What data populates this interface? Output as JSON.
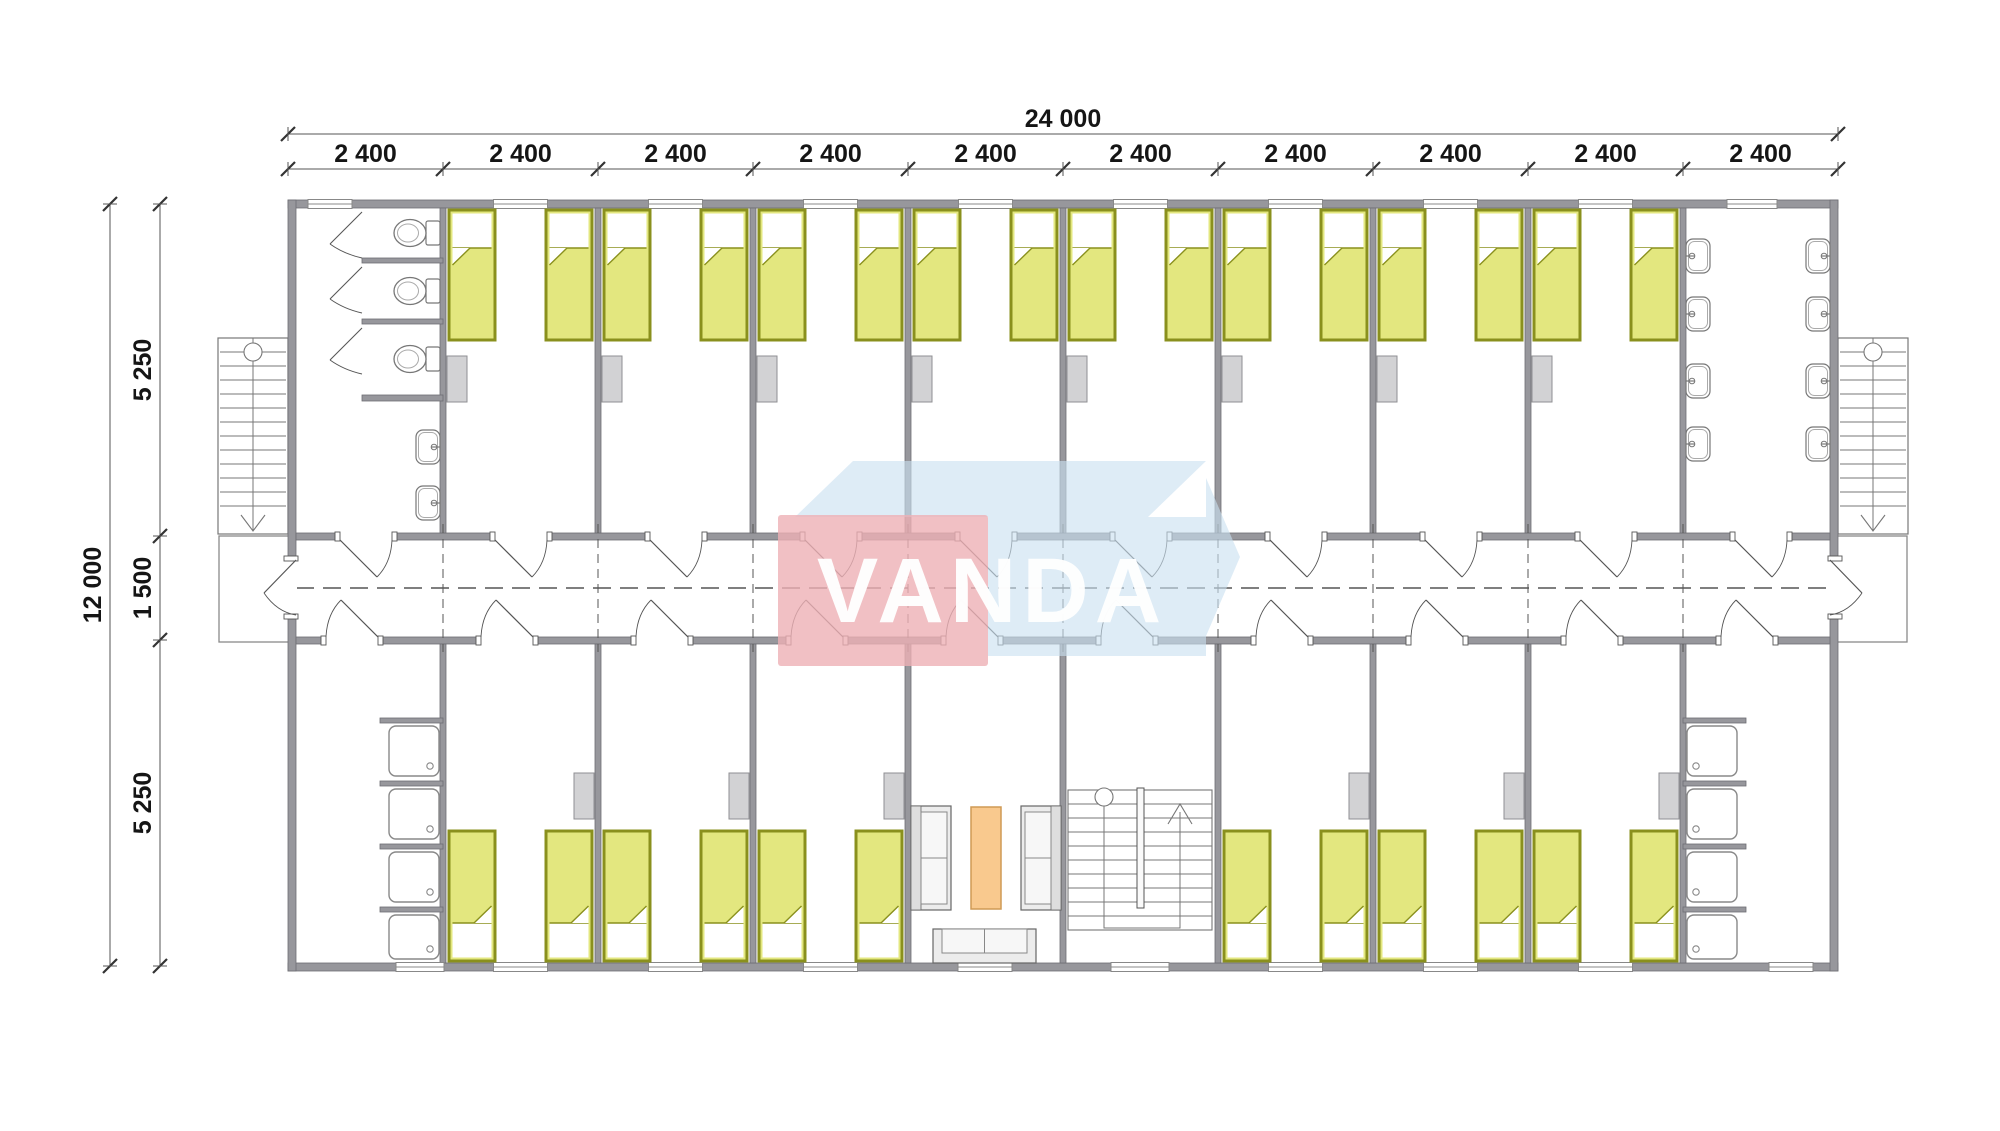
{
  "drawing": {
    "kind": "floor-plan",
    "building": "two-row dormitory module with central corridor"
  },
  "dimensions": {
    "top_total": "24 000",
    "top_segments": [
      "2 400",
      "2 400",
      "2 400",
      "2 400",
      "2 400",
      "2 400",
      "2 400",
      "2 400",
      "2 400",
      "2 400"
    ],
    "left_total": "12 000",
    "left_segments": [
      "5 250",
      "1 500",
      "5 250"
    ]
  },
  "watermark": {
    "text": "VANDA",
    "front_color": "#eeb0b5",
    "side_color": "#c9e0f0",
    "text_color": "#ffffff"
  },
  "colors": {
    "wall": "#97979c",
    "wall_edge": "#6e6e73",
    "line": "#666666",
    "bed_fill": "#e3e77f",
    "bed_border": "#8a901d",
    "pillow": "#ffffff",
    "wardrobe": "#d2d2d4",
    "wardrobe_edge": "#8f8f93",
    "fixture": "#777777",
    "furniture_fill": "#ececec",
    "furniture_edge": "#666666",
    "seat_fill": "#f7f7f7",
    "table_fill": "#f9c98e",
    "table_edge": "#cf9a55",
    "dim_line": "#555555",
    "tick": "#333333",
    "dim_text": "#151515",
    "centerline": "#555555"
  },
  "rooms": {
    "top": [
      {
        "type": "toilet-room",
        "toilet_stalls": 3,
        "wall_sinks": 2
      },
      {
        "type": "bedroom",
        "beds": 2,
        "wardrobe": true
      },
      {
        "type": "bedroom",
        "beds": 2,
        "wardrobe": true
      },
      {
        "type": "bedroom",
        "beds": 2,
        "wardrobe": true
      },
      {
        "type": "bedroom",
        "beds": 2,
        "wardrobe": true
      },
      {
        "type": "bedroom",
        "beds": 2,
        "wardrobe": true
      },
      {
        "type": "bedroom",
        "beds": 2,
        "wardrobe": true
      },
      {
        "type": "bedroom",
        "beds": 2,
        "wardrobe": true
      },
      {
        "type": "bedroom",
        "beds": 2,
        "wardrobe": true
      },
      {
        "type": "washroom",
        "wall_sinks": 8
      }
    ],
    "bottom": [
      {
        "type": "shower-room",
        "shower_trays": 4
      },
      {
        "type": "bedroom",
        "beds": 2,
        "wardrobe": true
      },
      {
        "type": "bedroom",
        "beds": 2,
        "wardrobe": true
      },
      {
        "type": "bedroom",
        "beds": 2,
        "wardrobe": true
      },
      {
        "type": "lounge",
        "furniture": [
          "armchair",
          "coffee-table",
          "armchair",
          "sofa"
        ]
      },
      {
        "type": "stair-room",
        "internal_stair": true
      },
      {
        "type": "bedroom",
        "beds": 2,
        "wardrobe": true
      },
      {
        "type": "bedroom",
        "beds": 2,
        "wardrobe": true
      },
      {
        "type": "bedroom",
        "beds": 2,
        "wardrobe": true
      },
      {
        "type": "shower-room",
        "shower_trays": 4
      }
    ],
    "corridor": {
      "door_per_room": true,
      "entrance_doors": 2
    },
    "external_stairs": 2,
    "entrance_landings": 2
  }
}
